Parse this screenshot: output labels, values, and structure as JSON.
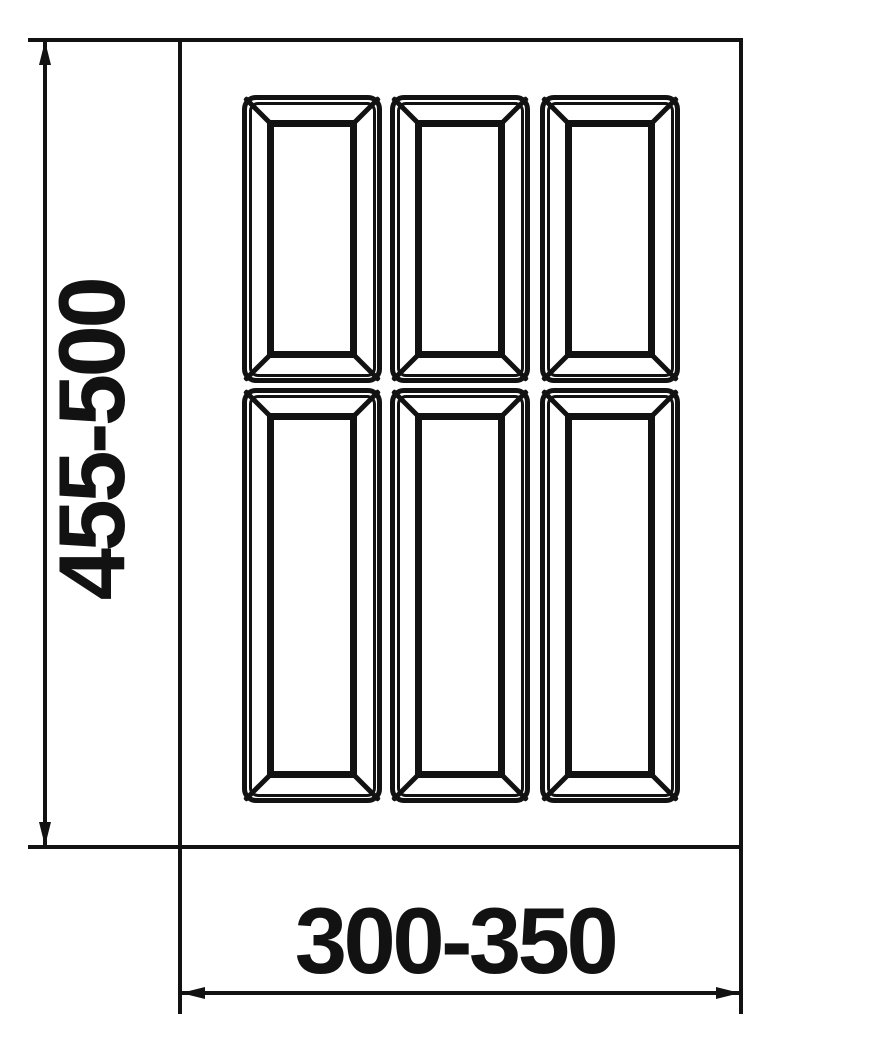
{
  "drawing": {
    "description": "Technical dimension drawing of a drawer cutlery tray insert with 6 beveled compartments",
    "background_color": "#ffffff",
    "line_color": "#121212",
    "height_dimension": {
      "label": "455-500"
    },
    "width_dimension": {
      "label": "300-350"
    },
    "compartment_grid": {
      "rows": 2,
      "columns": 3,
      "total": 6
    }
  }
}
